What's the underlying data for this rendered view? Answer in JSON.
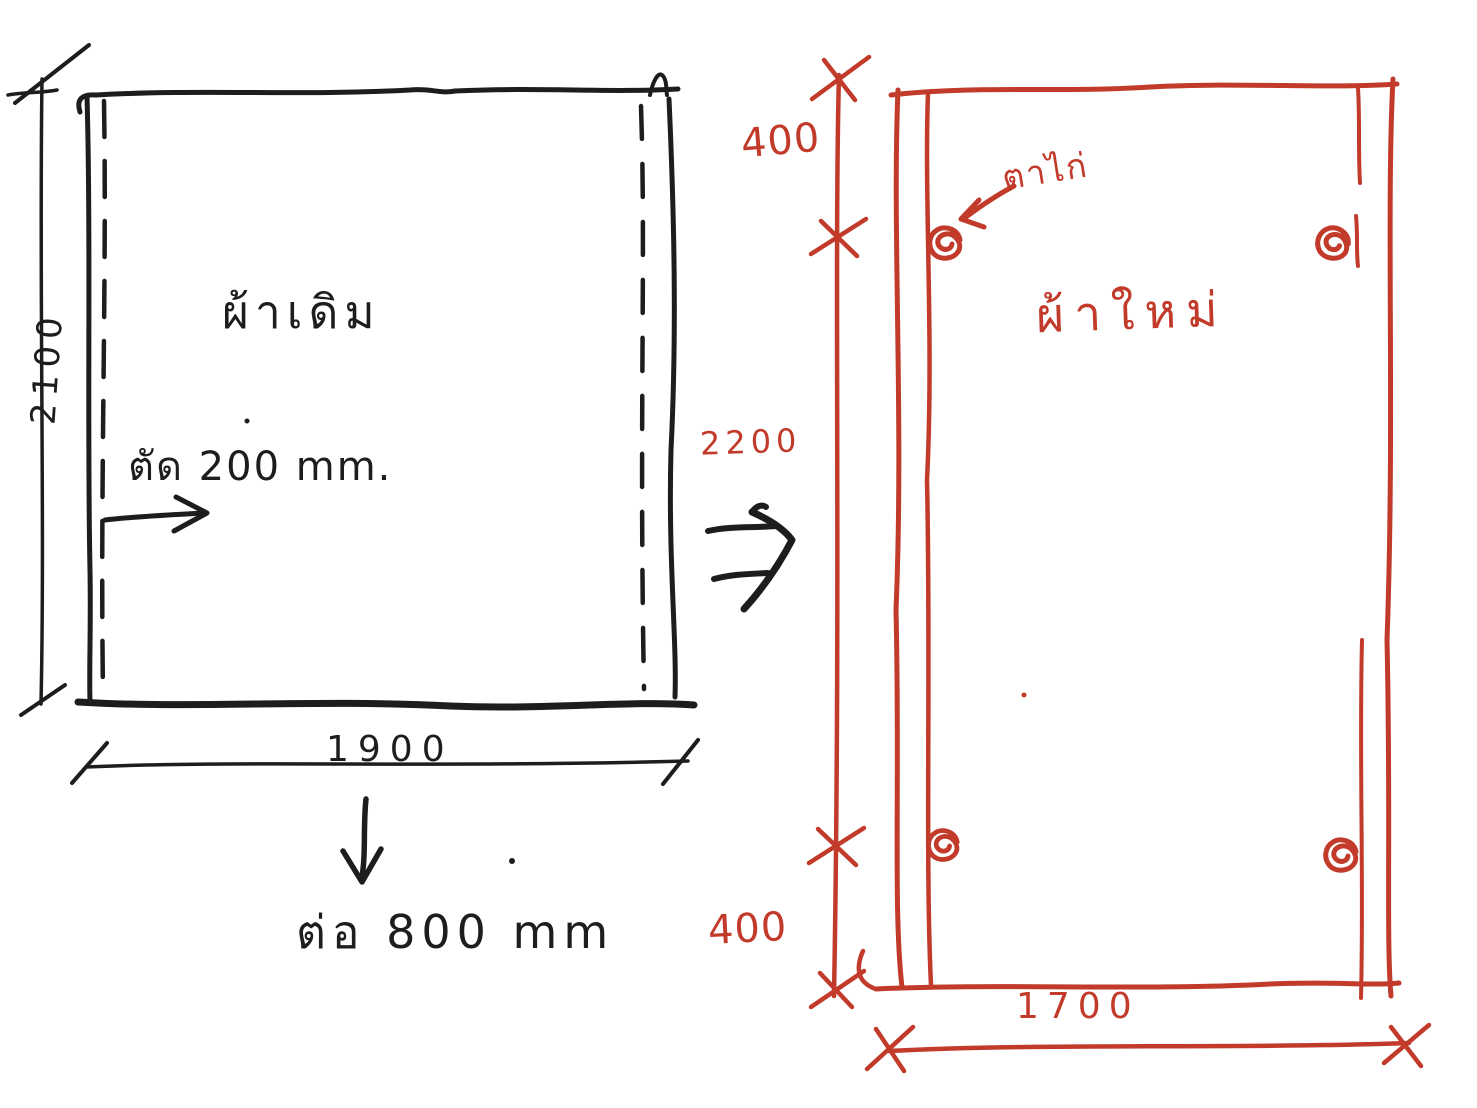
{
  "colors": {
    "background": "#ffffff",
    "ink_black": "#1d1d1f",
    "ink_red": "#c23a2a"
  },
  "original_fabric": {
    "title": "ผ้าเดิม",
    "height_dim": "2100",
    "width_dim": "1900",
    "cut_note": "ตัด 200 mm.",
    "extend_note": "ต่อ 800 mm"
  },
  "new_fabric": {
    "title": "ผ้าใหม่",
    "eyelet_note": "ตาไก่",
    "top_margin_dim": "400",
    "middle_dim": "2200",
    "bottom_margin_dim": "400",
    "width_dim": "1700"
  }
}
